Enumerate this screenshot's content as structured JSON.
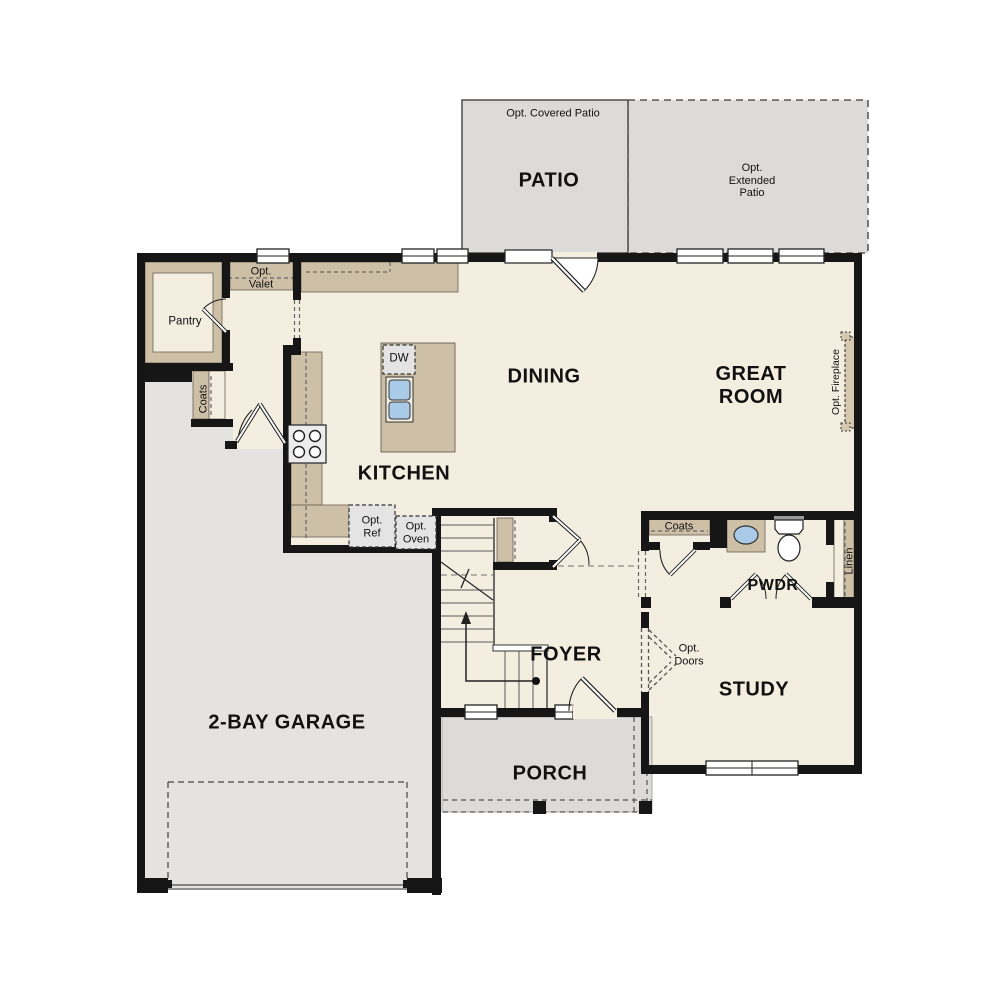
{
  "plan": {
    "title": "First floor plan",
    "labels": {
      "opt_covered_patio": "Opt. Covered Patio",
      "patio": "PATIO",
      "opt_extended_patio": "Opt.\nExtended\nPatio",
      "opt_valet": "Opt.\nValet",
      "pantry": "Pantry",
      "coats_mud": "Coats",
      "dw": "DW",
      "dining": "DINING",
      "great_room": "GREAT\nROOM",
      "kitchen": "KITCHEN",
      "opt_ref": "Opt.\nRef",
      "opt_oven": "Opt.\nOven",
      "opt_fireplace": "Opt. Fireplace",
      "coats_hall": "Coats",
      "pwdr": "PWDR",
      "linen": "Linen",
      "foyer": "FOYER",
      "opt_doors": "Opt.\nDoors",
      "study": "STUDY",
      "garage": "2-BAY GARAGE",
      "porch": "PORCH"
    },
    "colors": {
      "floor": "#f4eee1",
      "patio_gray": "#dcdbd9",
      "garage_gray": "#e4e3e1",
      "counter_tan": "#cec0a7",
      "fireplace_tan": "#d6c9b0",
      "wall_black": "#161616",
      "appliance_gray": "#e4e4e4",
      "sink_blue": "#aacbe8"
    }
  }
}
